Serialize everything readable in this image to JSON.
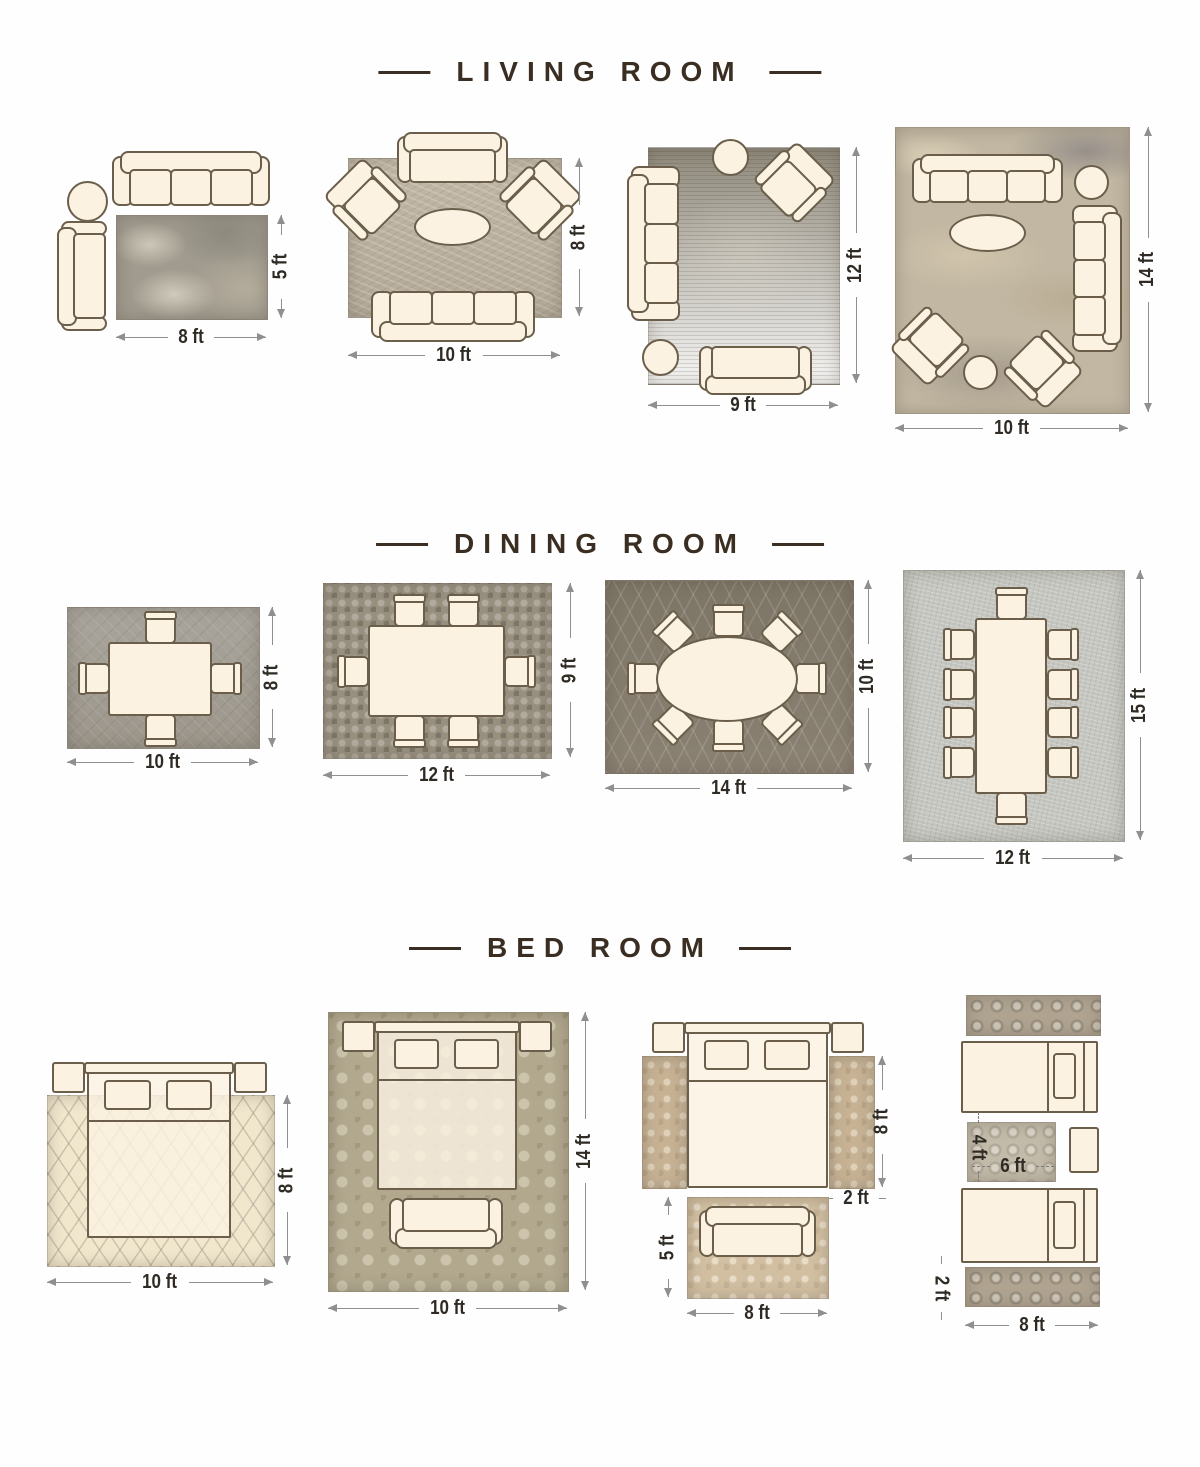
{
  "palette": {
    "background": "#ffffff",
    "title_text": "#3a2e22",
    "dimension_text": "#2f2b24",
    "dimension_line": "#8f8f8f",
    "furniture_fill": "#fbf2e2",
    "furniture_outline": "#6b5f4b"
  },
  "sections": [
    {
      "title": "LIVING ROOM",
      "layouts": [
        {
          "rug_width": "8 ft",
          "rug_height": "5 ft"
        },
        {
          "rug_width": "10 ft",
          "rug_height": "8 ft"
        },
        {
          "rug_width": "9 ft",
          "rug_height": "12 ft"
        },
        {
          "rug_width": "10 ft",
          "rug_height": "14 ft"
        }
      ]
    },
    {
      "title": "DINING ROOM",
      "layouts": [
        {
          "rug_width": "10 ft",
          "rug_height": "8 ft"
        },
        {
          "rug_width": "12 ft",
          "rug_height": "9 ft"
        },
        {
          "rug_width": "14 ft",
          "rug_height": "10 ft"
        },
        {
          "rug_width": "12 ft",
          "rug_height": "15 ft"
        }
      ]
    },
    {
      "title": "BED ROOM",
      "layouts": [
        {
          "rug_width": "10 ft",
          "rug_height": "8 ft"
        },
        {
          "rug_width": "10 ft",
          "rug_height": "14 ft"
        },
        {
          "runner_height": "8 ft",
          "runner_width": "2 ft",
          "foot_rug_height": "5 ft",
          "foot_rug_width": "8 ft"
        },
        {
          "accent_rug_height": "4 ft",
          "accent_rug_width": "6 ft",
          "runner_height": "2 ft",
          "runner_width": "8 ft"
        }
      ]
    }
  ]
}
